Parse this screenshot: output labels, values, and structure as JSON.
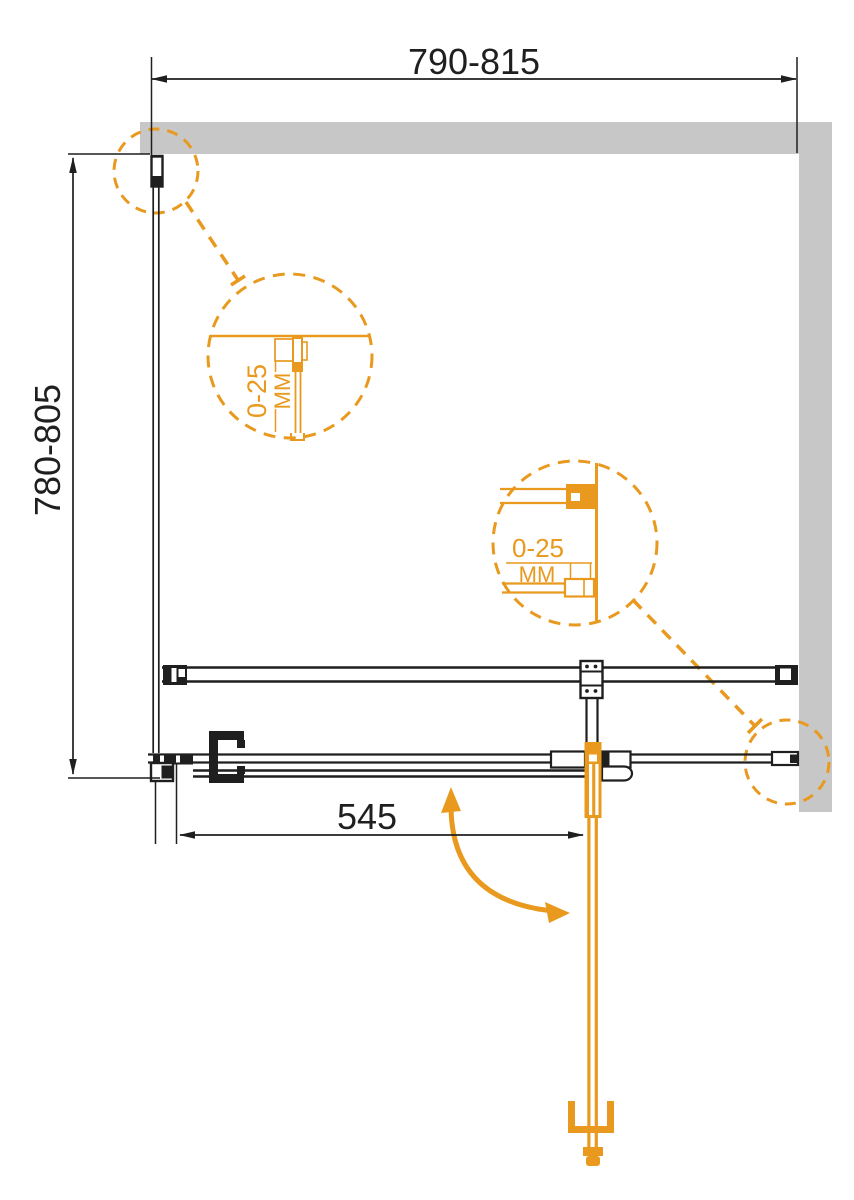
{
  "colors": {
    "accent_orange": "#E8991E",
    "line_black": "#1F1F1F",
    "wall_gray": "#C7C7C7",
    "background": "#FFFFFF"
  },
  "dimensions": {
    "width_range": "790-815",
    "height_range": "780-805",
    "door_width": "545"
  },
  "adjustment_details": {
    "left": {
      "range": "0-25",
      "unit": "ММ"
    },
    "right": {
      "range": "0-25",
      "unit": "ММ"
    }
  }
}
